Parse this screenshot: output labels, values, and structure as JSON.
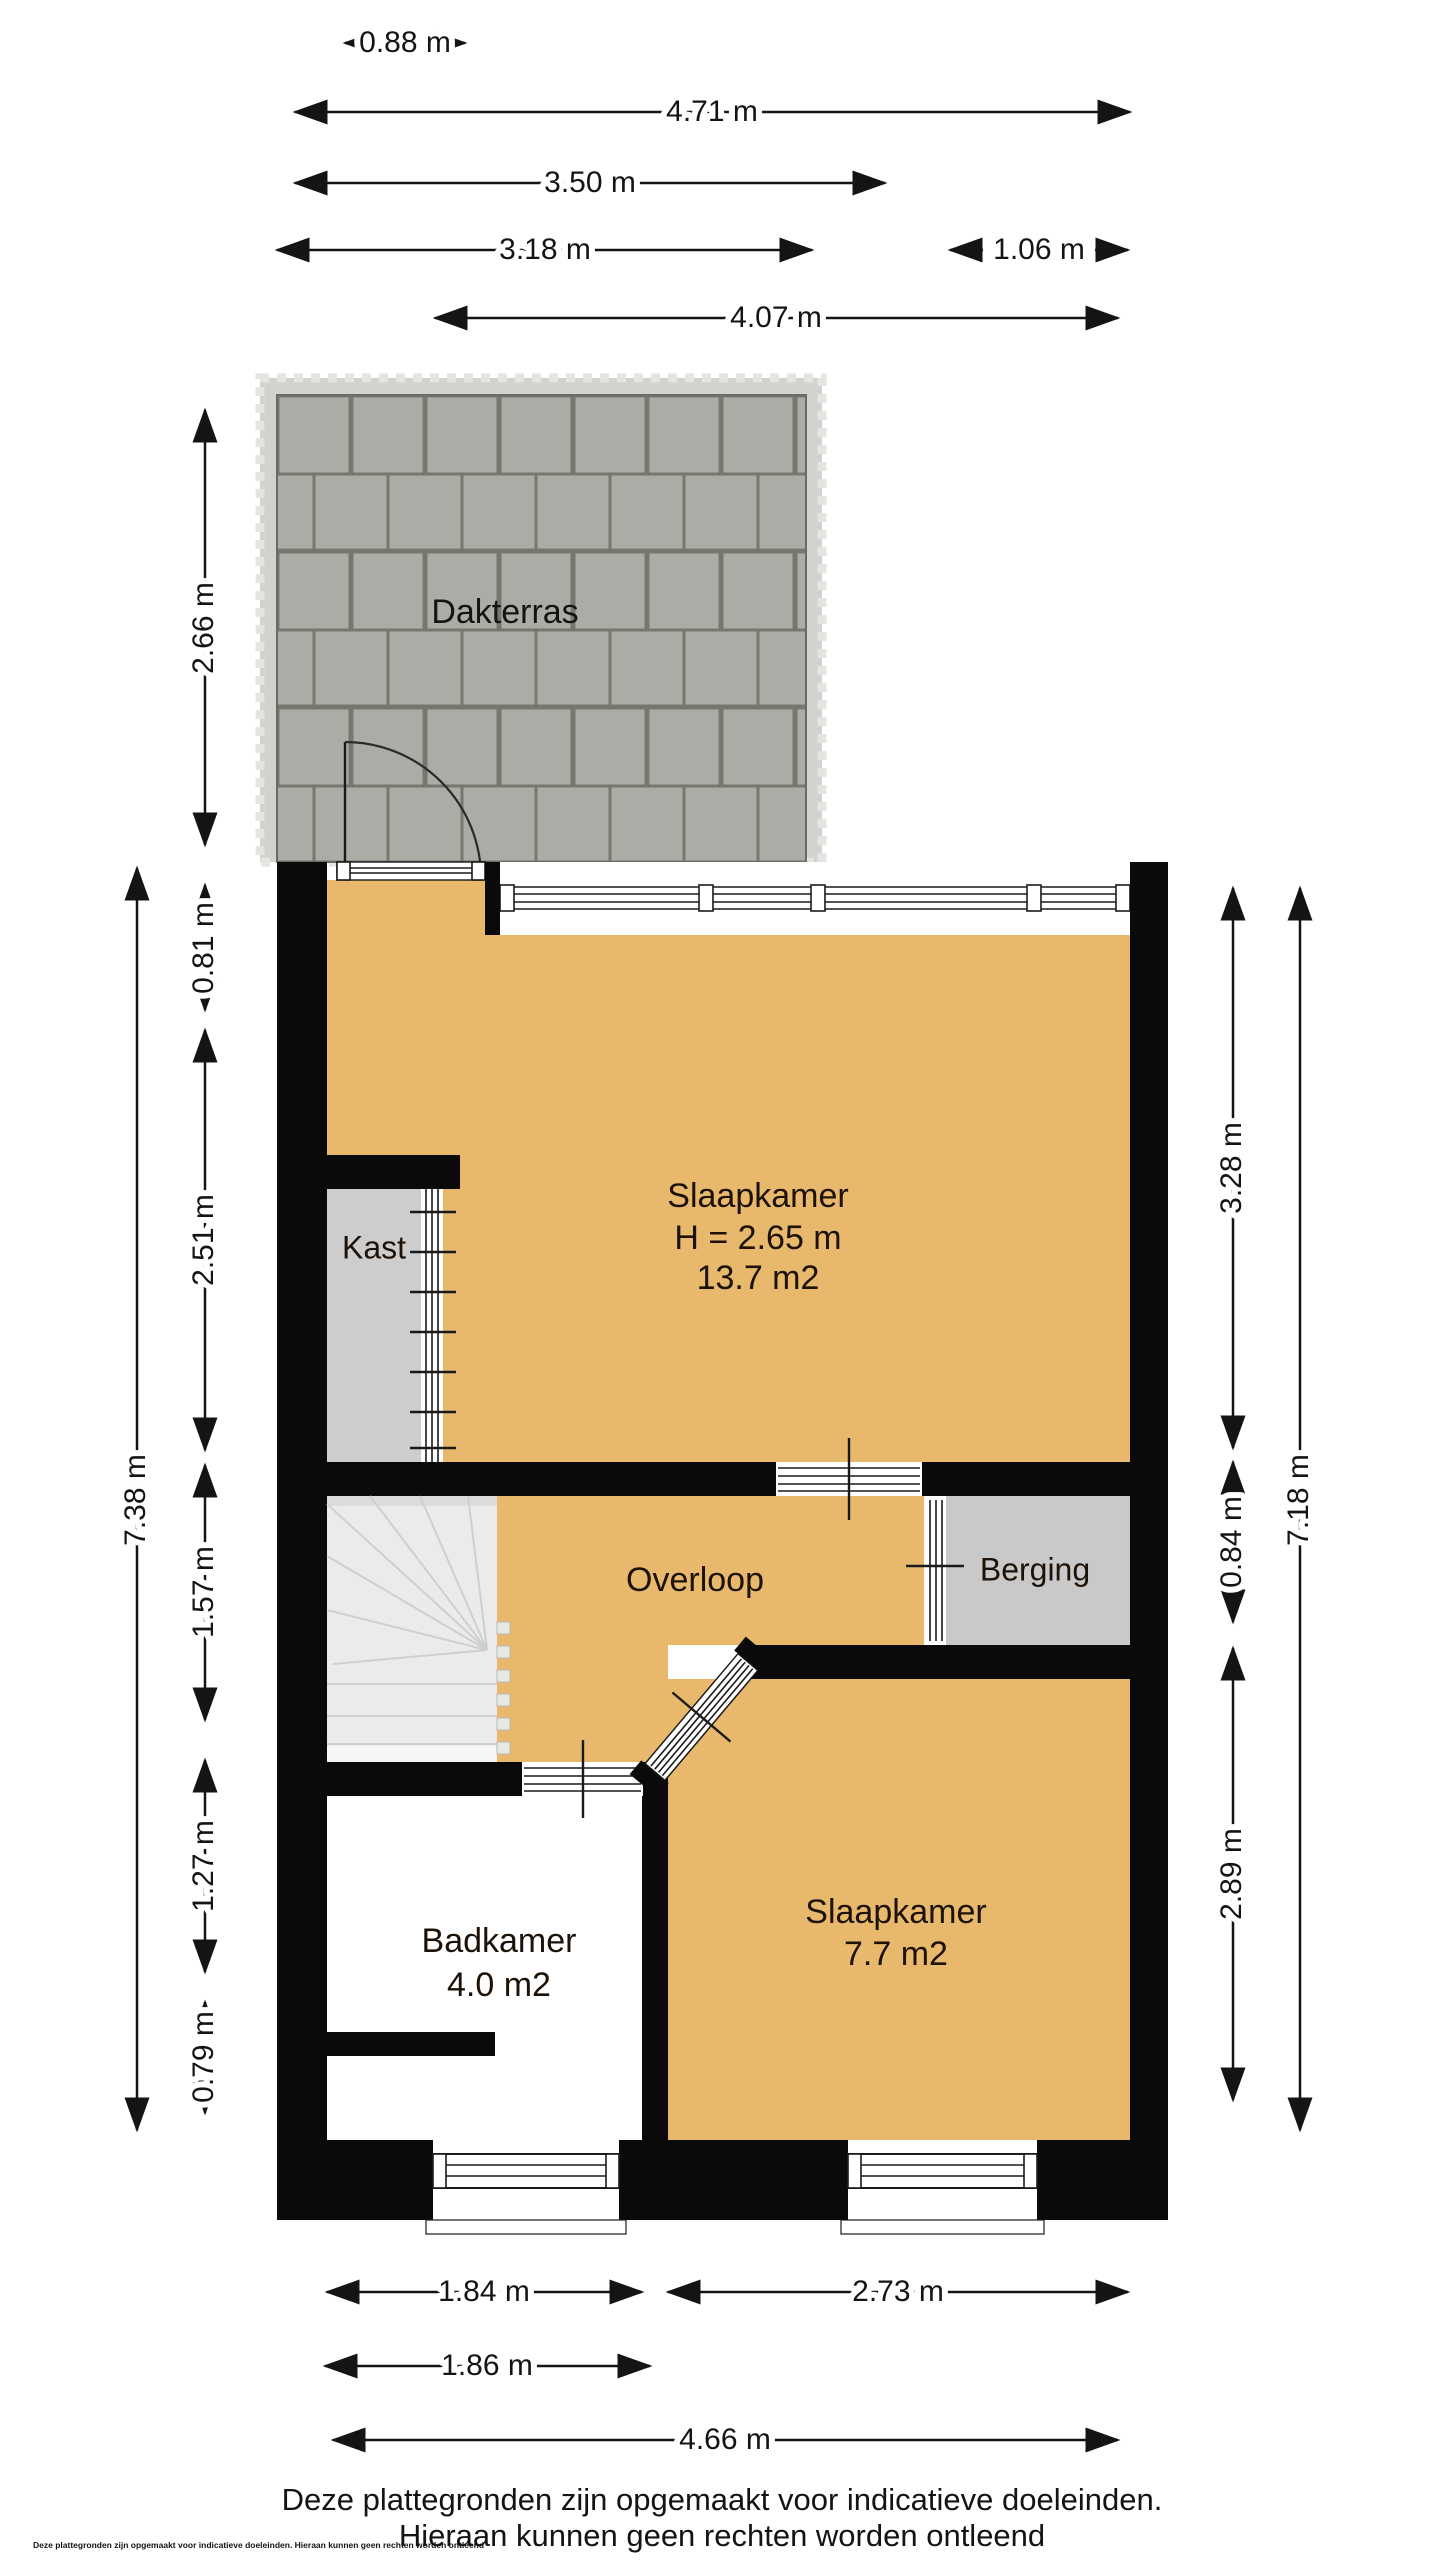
{
  "rooms": {
    "dakterras": {
      "label": "Dakterras"
    },
    "slaapkamer1": {
      "label": "Slaapkamer",
      "height": "H = 2.65 m",
      "area": "13.7 m2"
    },
    "kast": {
      "label": "Kast"
    },
    "overloop": {
      "label": "Overloop"
    },
    "berging": {
      "label": "Berging"
    },
    "badkamer": {
      "label": "Badkamer",
      "area": "4.0 m2"
    },
    "slaapkamer2": {
      "label": "Slaapkamer",
      "area": "7.7 m2"
    }
  },
  "dimensions": {
    "top": [
      "0.88 m",
      "4.71 m",
      "3.50 m",
      "3.18 m",
      "1.06 m",
      "4.07 m"
    ],
    "left": [
      "2.66 m",
      "0.81 m",
      "2.51 m",
      "1.57 m",
      "1.27 m",
      "0.79 m",
      "7.38 m"
    ],
    "right": [
      "3.28 m",
      "0.84 m",
      "2.89 m",
      "7.18 m"
    ],
    "bottom": [
      "1.84 m",
      "2.73 m",
      "1.86 m",
      "4.66 m"
    ]
  },
  "footer": {
    "line1": "Deze plattegronden zijn opgemaakt voor indicatieve doeleinden.",
    "line2": "Hieraan kunnen geen rechten worden ontleend",
    "fine_print": "Deze plattegronden zijn opgemaakt voor indicatieve doeleinden. Hieraan kunnen geen rechten worden ontleend"
  },
  "colors": {
    "floor": "#e8b96c",
    "wall": "#0a0a0a",
    "tile": "#acaca7",
    "joint": "#77776f",
    "closet": "#cdcdcd",
    "storage": "#c9c9c9",
    "stairs": "#ebebeb"
  }
}
